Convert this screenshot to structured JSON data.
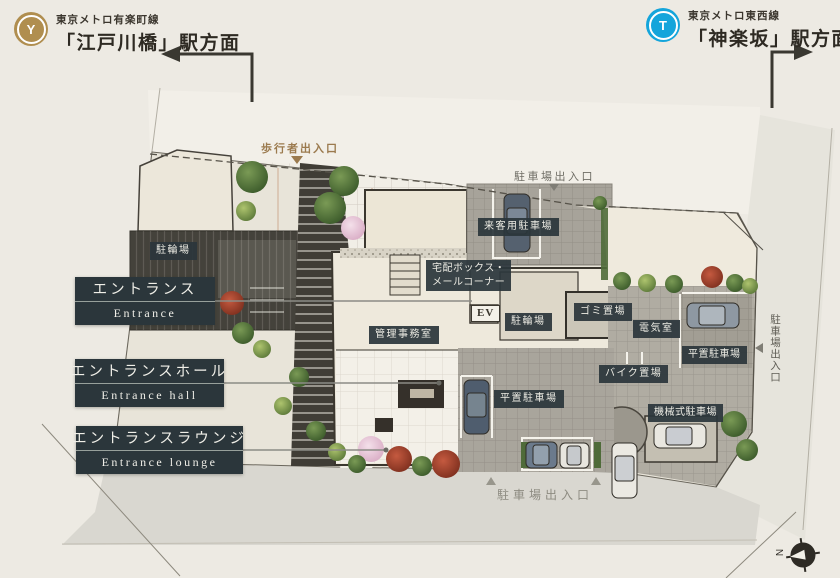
{
  "header": {
    "left": {
      "badge": "Y",
      "line_name": "東京メトロ有楽町線",
      "station": "「江戸川橋」駅方面",
      "badge_color": "#b08e4f"
    },
    "right": {
      "badge": "T",
      "line_name": "東京メトロ東西線",
      "station": "「神楽坂」駅方面",
      "badge_color": "#14a5db"
    }
  },
  "legend": [
    {
      "jp": "エントランス",
      "en": "Entrance"
    },
    {
      "jp": "エントランスホール",
      "en": "Entrance hall"
    },
    {
      "jp": "エントランスラウンジ",
      "en": "Entrance lounge"
    }
  ],
  "labels": {
    "bicycle_left": "駐輪場",
    "visitor_parking": "来客用駐車場",
    "delivery_line1": "宅配ボックス・",
    "delivery_line2": "メールコーナー",
    "elevator": "EV",
    "office": "管理事務室",
    "bicycle_center": "駐輪場",
    "garbage": "ゴミ置場",
    "electrical": "電気室",
    "flat_parking_right": "平置駐車場",
    "motorcycle": "バイク置場",
    "flat_parking_bottom": "平置駐車場",
    "mechanical_parking": "機械式駐車場"
  },
  "annotations": {
    "pedestrian_entrance": "歩行者出入口",
    "parking_entrance_top": "駐車場出入口",
    "parking_entrance_bottom": "駐車場出入口",
    "parking_entrance_right": "駐車場出入口",
    "north": "N"
  },
  "colors": {
    "accent_gold": "#b08e4f",
    "metro_blue": "#14a5db",
    "label_bg": "#2b363b",
    "paper": "#edeae3"
  }
}
